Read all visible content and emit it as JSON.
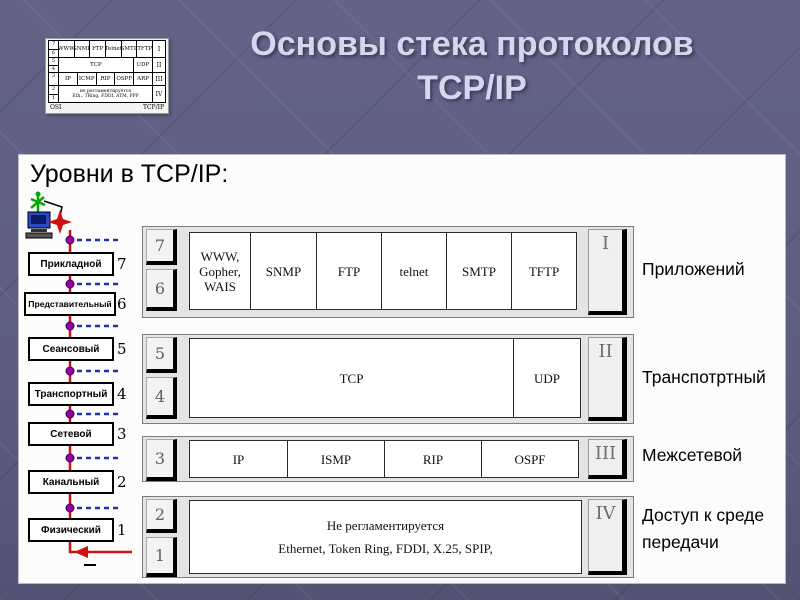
{
  "slide": {
    "title_line1": "Основы стека протоколов",
    "title_line2": "TCP/IP",
    "heading": "Уровни в TCP/IP:"
  },
  "thumbnail": {
    "rows": [
      {
        "levels": [
          "7",
          "6"
        ],
        "cells": [
          "WWW",
          "SNMP",
          "FTP",
          "Telnet",
          "SMTP",
          "TFTP"
        ],
        "numeral": "I"
      },
      {
        "levels": [
          "5",
          "4"
        ],
        "cells": [
          "TCP",
          "UDP"
        ],
        "numeral": "II"
      },
      {
        "levels": [
          "3"
        ],
        "cells": [
          "IP",
          "ICMP",
          "RIP",
          "OSPF",
          "ARP"
        ],
        "numeral": "III"
      },
      {
        "levels": [
          "2",
          "1"
        ],
        "lines": [
          "не регламентируется",
          "Eth., TRing, FDDI, ATM, PPP"
        ],
        "numeral": "IV"
      }
    ],
    "footer_left": "OSI",
    "footer_right": "TCP/IP"
  },
  "osi_layers": [
    {
      "name": "Прикладной",
      "number": "7"
    },
    {
      "name": "Представительный",
      "number": "6"
    },
    {
      "name": "Сеансовый",
      "number": "5"
    },
    {
      "name": "Транспортный",
      "number": "4"
    },
    {
      "name": "Сетевой",
      "number": "3"
    },
    {
      "name": "Канальный",
      "number": "2"
    },
    {
      "name": "Физический",
      "number": "1"
    }
  ],
  "tcp_rows": [
    {
      "level_numbers": [
        "7",
        "6"
      ],
      "numeral": "I",
      "label": "Приложений",
      "cells": [
        "WWW, Gopher, WAIS",
        "SNMP",
        "FTP",
        "telnet",
        "SMTP",
        "TFTP"
      ]
    },
    {
      "level_numbers": [
        "5",
        "4"
      ],
      "numeral": "II",
      "label": "Транспотртный",
      "cells": [
        "TCP",
        "UDP"
      ]
    },
    {
      "level_numbers": [
        "3"
      ],
      "numeral": "III",
      "label": "Межсетевой",
      "cells": [
        "IP",
        "ISMP",
        "RIP",
        "OSPF"
      ]
    },
    {
      "level_numbers": [
        "2",
        "1"
      ],
      "numeral": "IV",
      "label": "Доступ к среде передачи",
      "lines": [
        "Не регламентируется",
        "Ethernet, Token Ring, FDDI, X.25, SPIP,"
      ]
    }
  ],
  "colors": {
    "slide_background": "#5c5d81",
    "title_text": "#d8d5ee",
    "flow_line_red": "#cc1111",
    "junction_dot_purple": "#990099",
    "dashed_link_blue": "#2233aa",
    "row_panel_gray": "#e4e4e4"
  }
}
